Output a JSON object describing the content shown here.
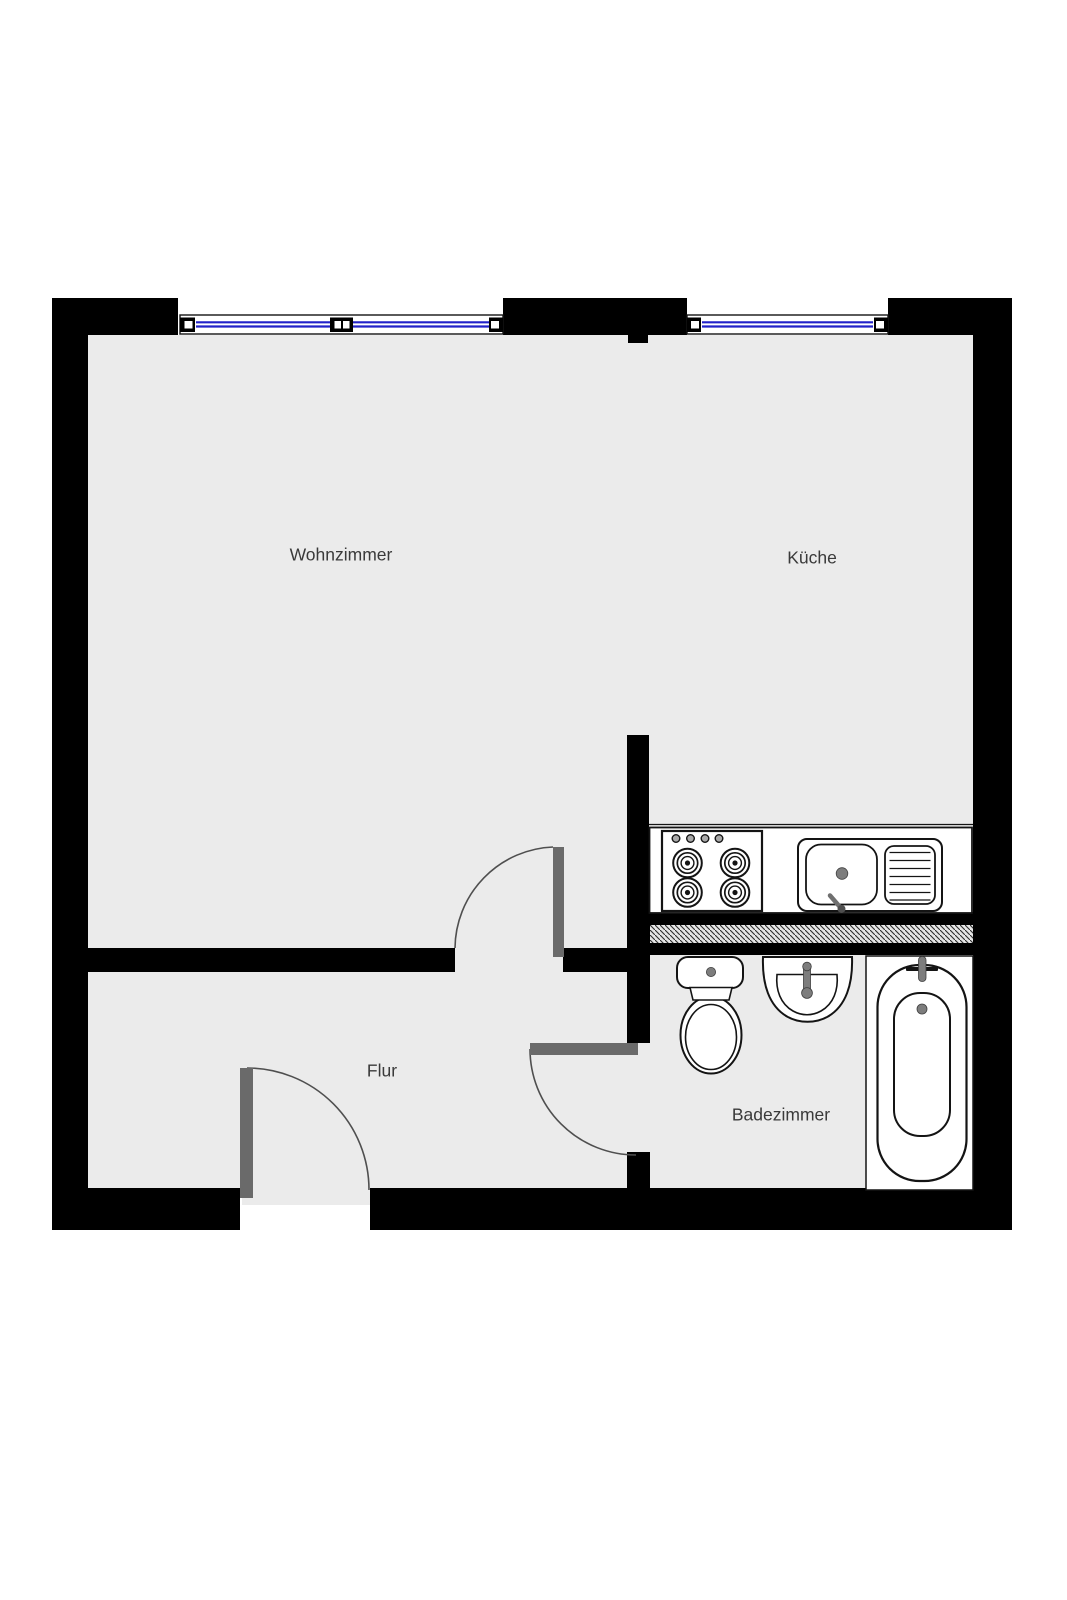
{
  "diagram": {
    "type": "floor-plan",
    "description": "apartment floor plan with living room, kitchen, hallway and bathroom"
  },
  "rooms": [
    {
      "id": "wohnzimmer",
      "label": "Wohnzimmer"
    },
    {
      "id": "kueche",
      "label": "Küche"
    },
    {
      "id": "flur",
      "label": "Flur"
    },
    {
      "id": "badezimmer",
      "label": "Badezimmer"
    }
  ],
  "windows": [
    {
      "id": "window-wohnzimmer",
      "wall": "top",
      "glazing": "double-line",
      "mullion": true
    },
    {
      "id": "window-kueche",
      "wall": "top",
      "glazing": "double-line",
      "mullion": false
    }
  ],
  "doors": [
    {
      "id": "door-entrance",
      "swing": "into-flur"
    },
    {
      "id": "door-wohnzimmer",
      "swing": "into-wohnzimmer"
    },
    {
      "id": "door-badezimmer",
      "swing": "into-flur"
    }
  ],
  "fixtures": [
    {
      "id": "stove",
      "burners": 4,
      "knobs": 4
    },
    {
      "id": "kitchen-sink",
      "parts": [
        "basin",
        "drain",
        "faucet-lever",
        "drainboard"
      ]
    },
    {
      "id": "toilet",
      "parts": [
        "tank",
        "flush-button",
        "bowl"
      ]
    },
    {
      "id": "washbasin",
      "parts": [
        "basin",
        "faucet"
      ]
    },
    {
      "id": "bathtub",
      "parts": [
        "tub",
        "faucet",
        "drain"
      ]
    }
  ],
  "colors": {
    "wall": "#000000",
    "floor": "#ebebeb",
    "window-blue": "#2121c8",
    "door-leaf": "#6a6a6a",
    "swing-arc": "#4f4f4f",
    "outline": "#141414",
    "metal": "#7d7d7d",
    "label": "#3a3a3a",
    "hatch-bg": "#e6e6e6",
    "paper": "#ffffff"
  }
}
